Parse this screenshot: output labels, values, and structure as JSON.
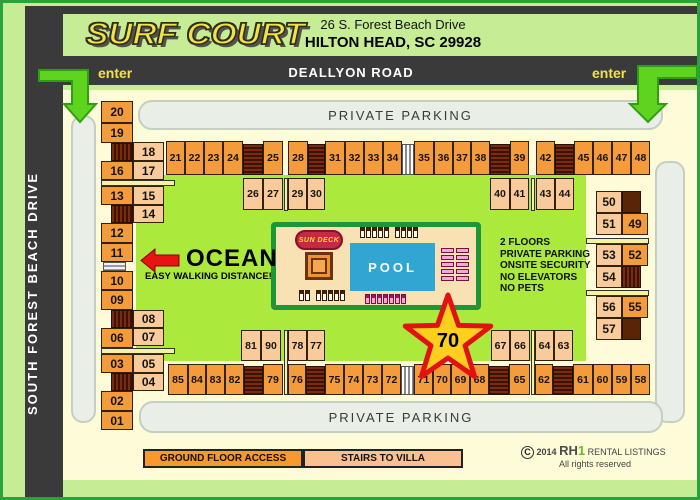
{
  "header": {
    "logo": "SURF COURT",
    "address_line1": "26 S. Forest Beach Drive",
    "address_line2": "HILTON HEAD, SC  29928"
  },
  "roads": {
    "top_label": "DEALLYON ROAD",
    "left_label": "SOUTH FOREST BEACH DRIVE",
    "enter_left": "enter",
    "enter_right": "enter"
  },
  "parking": {
    "top_label": "PRIVATE PARKING",
    "bottom_label": "PRIVATE PARKING"
  },
  "ocean": {
    "label": "OCEAN",
    "sub_label": "EASY WALKING DISTANCE!"
  },
  "info": {
    "lines": [
      "2 FLOORS",
      "PRIVATE PARKING",
      "ONSITE SECURITY",
      "NO ELEVATORS",
      "NO PETS"
    ]
  },
  "pool": {
    "label": "POOL",
    "sun_deck_label": "SUN DECK"
  },
  "star": {
    "label": "70"
  },
  "legend": {
    "ground_label": "GROUND FLOOR ACCESS",
    "stairs_label": "STAIRS TO VILLA"
  },
  "footer": {
    "year": "2014",
    "brand_rh": "RH",
    "brand_one": "1",
    "brand_rest": "RENTAL LISTINGS",
    "rights": "All rights reserved"
  },
  "colors": {
    "page_green": "#c6ec95",
    "border_green": "#2aa33c",
    "road_dark": "#3a3a3a",
    "map_cream": "#fdfbd8",
    "courtyard_green": "#abe93c",
    "unit_orange": "#f49b3b",
    "unit_peach": "#f9cb9b",
    "pool_blue": "#31a6d2",
    "deck_tan": "#f8e2b4",
    "deck_border": "#1e9637",
    "star_red": "#e31212",
    "star_yellow": "#ffcf1d",
    "arrow_green": "#5ed41e",
    "enter_yellow": "#f0e34a"
  },
  "units": [
    {
      "label": "20",
      "x": 98,
      "y": 98,
      "w": 32,
      "h": 22,
      "t": "o"
    },
    {
      "label": "19",
      "x": 98,
      "y": 120,
      "w": 32,
      "h": 20,
      "t": "o"
    },
    {
      "label": "18",
      "x": 130,
      "y": 139,
      "w": 31,
      "h": 19,
      "t": "p"
    },
    {
      "label": "16",
      "x": 98,
      "y": 158,
      "w": 32,
      "h": 19,
      "t": "o"
    },
    {
      "label": "17",
      "x": 130,
      "y": 158,
      "w": 31,
      "h": 19,
      "t": "p"
    },
    {
      "label": "13",
      "x": 98,
      "y": 183,
      "w": 32,
      "h": 19,
      "t": "o"
    },
    {
      "label": "15",
      "x": 130,
      "y": 183,
      "w": 31,
      "h": 19,
      "t": "p"
    },
    {
      "label": "14",
      "x": 130,
      "y": 202,
      "w": 31,
      "h": 18,
      "t": "p"
    },
    {
      "label": "12",
      "x": 98,
      "y": 220,
      "w": 32,
      "h": 20,
      "t": "o"
    },
    {
      "label": "11",
      "x": 98,
      "y": 240,
      "w": 32,
      "h": 19,
      "t": "o"
    },
    {
      "label": "10",
      "x": 98,
      "y": 268,
      "w": 32,
      "h": 19,
      "t": "o"
    },
    {
      "label": "09",
      "x": 98,
      "y": 287,
      "w": 32,
      "h": 20,
      "t": "o"
    },
    {
      "label": "08",
      "x": 130,
      "y": 307,
      "w": 31,
      "h": 18,
      "t": "p"
    },
    {
      "label": "06",
      "x": 98,
      "y": 325,
      "w": 32,
      "h": 20,
      "t": "o"
    },
    {
      "label": "07",
      "x": 130,
      "y": 325,
      "w": 31,
      "h": 18,
      "t": "p"
    },
    {
      "label": "03",
      "x": 98,
      "y": 351,
      "w": 32,
      "h": 19,
      "t": "o"
    },
    {
      "label": "05",
      "x": 130,
      "y": 351,
      "w": 31,
      "h": 19,
      "t": "p"
    },
    {
      "label": "04",
      "x": 130,
      "y": 370,
      "w": 31,
      "h": 18,
      "t": "p"
    },
    {
      "label": "02",
      "x": 98,
      "y": 388,
      "w": 32,
      "h": 20,
      "t": "o"
    },
    {
      "label": "01",
      "x": 98,
      "y": 408,
      "w": 32,
      "h": 19,
      "t": "o"
    },
    {
      "label": "21",
      "x": 163,
      "y": 138,
      "w": 19,
      "h": 34,
      "t": "o"
    },
    {
      "label": "22",
      "x": 182,
      "y": 138,
      "w": 19,
      "h": 34,
      "t": "o"
    },
    {
      "label": "23",
      "x": 201,
      "y": 138,
      "w": 19,
      "h": 34,
      "t": "o"
    },
    {
      "label": "24",
      "x": 220,
      "y": 138,
      "w": 20,
      "h": 34,
      "t": "o"
    },
    {
      "label": "25",
      "x": 260,
      "y": 138,
      "w": 20,
      "h": 34,
      "t": "o"
    },
    {
      "label": "26",
      "x": 240,
      "y": 175,
      "w": 20,
      "h": 32,
      "t": "p"
    },
    {
      "label": "27",
      "x": 260,
      "y": 175,
      "w": 20,
      "h": 32,
      "t": "p"
    },
    {
      "label": "28",
      "x": 285,
      "y": 138,
      "w": 20,
      "h": 34,
      "t": "o"
    },
    {
      "label": "29",
      "x": 285,
      "y": 175,
      "w": 19,
      "h": 32,
      "t": "p"
    },
    {
      "label": "30",
      "x": 304,
      "y": 175,
      "w": 18,
      "h": 32,
      "t": "p"
    },
    {
      "label": "31",
      "x": 322,
      "y": 138,
      "w": 20,
      "h": 34,
      "t": "o"
    },
    {
      "label": "32",
      "x": 342,
      "y": 138,
      "w": 19,
      "h": 34,
      "t": "o"
    },
    {
      "label": "33",
      "x": 361,
      "y": 138,
      "w": 19,
      "h": 34,
      "t": "o"
    },
    {
      "label": "34",
      "x": 380,
      "y": 138,
      "w": 19,
      "h": 34,
      "t": "o"
    },
    {
      "label": "35",
      "x": 411,
      "y": 138,
      "w": 20,
      "h": 34,
      "t": "o"
    },
    {
      "label": "36",
      "x": 431,
      "y": 138,
      "w": 19,
      "h": 34,
      "t": "o"
    },
    {
      "label": "37",
      "x": 450,
      "y": 138,
      "w": 18,
      "h": 34,
      "t": "o"
    },
    {
      "label": "38",
      "x": 468,
      "y": 138,
      "w": 19,
      "h": 34,
      "t": "o"
    },
    {
      "label": "39",
      "x": 507,
      "y": 138,
      "w": 19,
      "h": 34,
      "t": "o"
    },
    {
      "label": "40",
      "x": 487,
      "y": 175,
      "w": 20,
      "h": 32,
      "t": "p"
    },
    {
      "label": "41",
      "x": 507,
      "y": 175,
      "w": 19,
      "h": 32,
      "t": "p"
    },
    {
      "label": "42",
      "x": 533,
      "y": 138,
      "w": 19,
      "h": 34,
      "t": "o"
    },
    {
      "label": "43",
      "x": 533,
      "y": 175,
      "w": 19,
      "h": 32,
      "t": "p"
    },
    {
      "label": "44",
      "x": 552,
      "y": 175,
      "w": 19,
      "h": 32,
      "t": "p"
    },
    {
      "label": "45",
      "x": 571,
      "y": 138,
      "w": 19,
      "h": 34,
      "t": "o"
    },
    {
      "label": "46",
      "x": 590,
      "y": 138,
      "w": 19,
      "h": 34,
      "t": "o"
    },
    {
      "label": "47",
      "x": 609,
      "y": 138,
      "w": 19,
      "h": 34,
      "t": "o"
    },
    {
      "label": "48",
      "x": 628,
      "y": 138,
      "w": 19,
      "h": 34,
      "t": "o"
    },
    {
      "label": "50",
      "x": 593,
      "y": 188,
      "w": 26,
      "h": 22,
      "t": "p"
    },
    {
      "label": "51",
      "x": 593,
      "y": 210,
      "w": 26,
      "h": 22,
      "t": "p"
    },
    {
      "label": "49",
      "x": 619,
      "y": 210,
      "w": 26,
      "h": 22,
      "t": "o"
    },
    {
      "label": "53",
      "x": 593,
      "y": 241,
      "w": 26,
      "h": 22,
      "t": "p"
    },
    {
      "label": "52",
      "x": 619,
      "y": 241,
      "w": 26,
      "h": 22,
      "t": "o"
    },
    {
      "label": "54",
      "x": 593,
      "y": 263,
      "w": 26,
      "h": 22,
      "t": "p"
    },
    {
      "label": "56",
      "x": 593,
      "y": 293,
      "w": 26,
      "h": 22,
      "t": "p"
    },
    {
      "label": "55",
      "x": 619,
      "y": 293,
      "w": 26,
      "h": 22,
      "t": "o"
    },
    {
      "label": "57",
      "x": 593,
      "y": 315,
      "w": 26,
      "h": 22,
      "t": "p"
    },
    {
      "label": "81",
      "x": 238,
      "y": 327,
      "w": 20,
      "h": 31,
      "t": "p"
    },
    {
      "label": "90",
      "x": 258,
      "y": 327,
      "w": 20,
      "h": 31,
      "t": "p"
    },
    {
      "label": "78",
      "x": 285,
      "y": 327,
      "w": 19,
      "h": 31,
      "t": "p"
    },
    {
      "label": "77",
      "x": 304,
      "y": 327,
      "w": 18,
      "h": 31,
      "t": "p"
    },
    {
      "label": "67",
      "x": 488,
      "y": 327,
      "w": 19,
      "h": 31,
      "t": "p"
    },
    {
      "label": "66",
      "x": 507,
      "y": 327,
      "w": 20,
      "h": 31,
      "t": "p"
    },
    {
      "label": "64",
      "x": 532,
      "y": 327,
      "w": 19,
      "h": 31,
      "t": "p"
    },
    {
      "label": "63",
      "x": 551,
      "y": 327,
      "w": 19,
      "h": 31,
      "t": "p"
    },
    {
      "label": "85",
      "x": 165,
      "y": 361,
      "w": 20,
      "h": 31,
      "t": "o"
    },
    {
      "label": "84",
      "x": 185,
      "y": 361,
      "w": 18,
      "h": 31,
      "t": "o"
    },
    {
      "label": "83",
      "x": 203,
      "y": 361,
      "w": 19,
      "h": 31,
      "t": "o"
    },
    {
      "label": "82",
      "x": 222,
      "y": 361,
      "w": 19,
      "h": 31,
      "t": "o"
    },
    {
      "label": "79",
      "x": 260,
      "y": 361,
      "w": 20,
      "h": 31,
      "t": "o"
    },
    {
      "label": "76",
      "x": 285,
      "y": 361,
      "w": 18,
      "h": 31,
      "t": "o"
    },
    {
      "label": "75",
      "x": 322,
      "y": 361,
      "w": 19,
      "h": 31,
      "t": "o"
    },
    {
      "label": "74",
      "x": 341,
      "y": 361,
      "w": 19,
      "h": 31,
      "t": "o"
    },
    {
      "label": "73",
      "x": 360,
      "y": 361,
      "w": 19,
      "h": 31,
      "t": "o"
    },
    {
      "label": "72",
      "x": 379,
      "y": 361,
      "w": 19,
      "h": 31,
      "t": "o"
    },
    {
      "label": "71",
      "x": 411,
      "y": 361,
      "w": 19,
      "h": 31,
      "t": "o"
    },
    {
      "label": "70",
      "x": 430,
      "y": 361,
      "w": 18,
      "h": 31,
      "t": "o"
    },
    {
      "label": "69",
      "x": 448,
      "y": 361,
      "w": 19,
      "h": 31,
      "t": "o"
    },
    {
      "label": "68",
      "x": 467,
      "y": 361,
      "w": 19,
      "h": 31,
      "t": "o"
    },
    {
      "label": "65",
      "x": 506,
      "y": 361,
      "w": 21,
      "h": 31,
      "t": "o"
    },
    {
      "label": "62",
      "x": 532,
      "y": 361,
      "w": 18,
      "h": 31,
      "t": "o"
    },
    {
      "label": "61",
      "x": 570,
      "y": 361,
      "w": 20,
      "h": 31,
      "t": "o"
    },
    {
      "label": "60",
      "x": 590,
      "y": 361,
      "w": 19,
      "h": 31,
      "t": "o"
    },
    {
      "label": "59",
      "x": 609,
      "y": 361,
      "w": 19,
      "h": 31,
      "t": "o"
    },
    {
      "label": "58",
      "x": 628,
      "y": 361,
      "w": 19,
      "h": 31,
      "t": "o"
    }
  ],
  "features": [
    {
      "t": "stairs-v",
      "x": 108,
      "y": 140,
      "w": 22,
      "h": 18
    },
    {
      "t": "stairs-v",
      "x": 108,
      "y": 202,
      "w": 22,
      "h": 18
    },
    {
      "t": "stairs-v",
      "x": 108,
      "y": 307,
      "w": 22,
      "h": 18
    },
    {
      "t": "stairs-v",
      "x": 108,
      "y": 370,
      "w": 22,
      "h": 18
    },
    {
      "t": "gsteps-h",
      "x": 100,
      "y": 259,
      "w": 23,
      "h": 9
    },
    {
      "t": "walk",
      "x": 98,
      "y": 177,
      "w": 74,
      "h": 6
    },
    {
      "t": "walk",
      "x": 98,
      "y": 345,
      "w": 74,
      "h": 6
    },
    {
      "t": "stairs-h",
      "x": 240,
      "y": 141,
      "w": 20,
      "h": 31
    },
    {
      "t": "stairs-h",
      "x": 305,
      "y": 141,
      "w": 17,
      "h": 31
    },
    {
      "t": "stairs-h",
      "x": 487,
      "y": 141,
      "w": 20,
      "h": 31
    },
    {
      "t": "stairs-h",
      "x": 552,
      "y": 141,
      "w": 19,
      "h": 31
    },
    {
      "t": "gsteps-v",
      "x": 399,
      "y": 141,
      "w": 12,
      "h": 31
    },
    {
      "t": "walk",
      "x": 281,
      "y": 175,
      "w": 4,
      "h": 33
    },
    {
      "t": "walk",
      "x": 528,
      "y": 175,
      "w": 4,
      "h": 33
    },
    {
      "t": "block",
      "x": 619,
      "y": 188,
      "w": 19,
      "h": 22
    },
    {
      "t": "block",
      "x": 619,
      "y": 315,
      "w": 19,
      "h": 22
    },
    {
      "t": "stairs-v",
      "x": 619,
      "y": 263,
      "w": 19,
      "h": 22
    },
    {
      "t": "walk",
      "x": 583,
      "y": 235,
      "w": 63,
      "h": 6
    },
    {
      "t": "walk",
      "x": 583,
      "y": 287,
      "w": 63,
      "h": 6
    },
    {
      "t": "stairs-h",
      "x": 241,
      "y": 363,
      "w": 19,
      "h": 29
    },
    {
      "t": "stairs-h",
      "x": 303,
      "y": 363,
      "w": 19,
      "h": 29
    },
    {
      "t": "stairs-h",
      "x": 486,
      "y": 363,
      "w": 20,
      "h": 29
    },
    {
      "t": "stairs-h",
      "x": 550,
      "y": 363,
      "w": 20,
      "h": 29
    },
    {
      "t": "gsteps-v",
      "x": 398,
      "y": 363,
      "w": 13,
      "h": 29
    },
    {
      "t": "walk",
      "x": 281,
      "y": 327,
      "w": 4,
      "h": 65
    },
    {
      "t": "walk",
      "x": 528,
      "y": 327,
      "w": 4,
      "h": 65
    }
  ],
  "chairs": [
    {
      "t": "w",
      "dir": "row",
      "x": 357,
      "y": 224,
      "n": 5
    },
    {
      "t": "w",
      "dir": "row",
      "x": 392,
      "y": 224,
      "n": 4
    },
    {
      "t": "pv",
      "dir": "col",
      "x": 438,
      "y": 245,
      "n": 5
    },
    {
      "t": "pv",
      "dir": "col",
      "x": 453,
      "y": 245,
      "n": 5
    },
    {
      "t": "ph",
      "dir": "row",
      "x": 362,
      "y": 291,
      "n": 5
    },
    {
      "t": "ph",
      "dir": "row",
      "x": 392,
      "y": 291,
      "n": 2
    },
    {
      "t": "w",
      "dir": "row",
      "x": 296,
      "y": 287,
      "n": 2
    },
    {
      "t": "w",
      "dir": "row",
      "x": 313,
      "y": 287,
      "n": 5
    }
  ]
}
